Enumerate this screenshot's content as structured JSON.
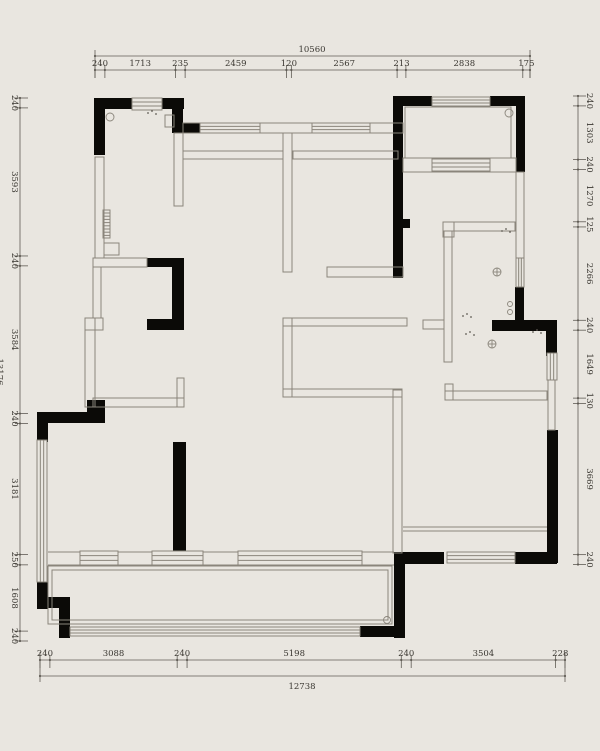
{
  "colors": {
    "background": "#e9e6e0",
    "wall": "#0b0a07",
    "thin_line": "#8a857b",
    "dimension_line": "#5f5b54",
    "text": "#3a3731"
  },
  "plan": {
    "top_chain": {
      "total": "10560",
      "segments": [
        240,
        1713,
        235,
        2459,
        120,
        2567,
        213,
        2838,
        175
      ]
    },
    "bottom_chain": {
      "total": "12738",
      "segments": [
        240,
        3088,
        240,
        5198,
        240,
        3504,
        228
      ]
    },
    "left_chain": {
      "total": "13176",
      "segments": [
        240,
        3593,
        240,
        3584,
        240,
        3181,
        250,
        1608,
        240
      ]
    },
    "right_chain": {
      "segments": [
        240,
        1303,
        240,
        1270,
        125,
        2266,
        240,
        1649,
        130,
        3669,
        240
      ]
    }
  }
}
